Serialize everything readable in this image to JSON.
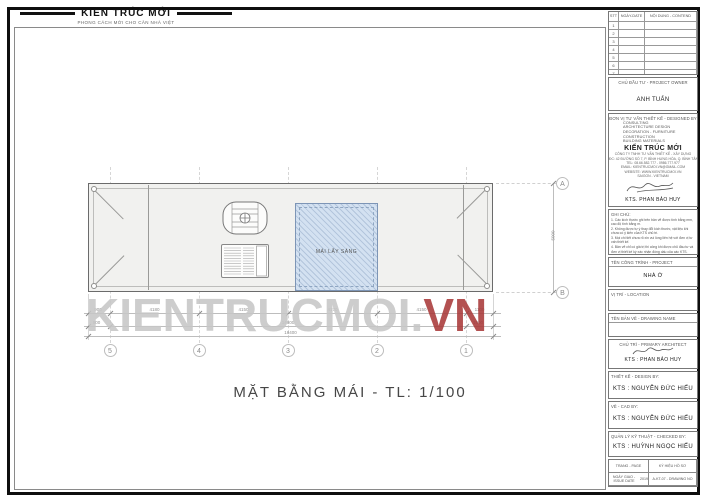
{
  "logo": {
    "title": "KIẾN TRÚC MỚI",
    "subtitle": "PHONG CÁCH MỚI CHO CĂN NHÀ VIỆT"
  },
  "watermark": {
    "gray": "KIENTRUCMOI.",
    "red": "VN"
  },
  "drawing": {
    "title": "MẶT BẰNG MÁI - TL: 1/100",
    "skylight_label": "MÁI LẤY SÁNG",
    "grid_cols": [
      "5",
      "4",
      "3",
      "2",
      "1"
    ],
    "grid_rows": [
      "A",
      "B"
    ],
    "dims": {
      "row1": [
        "900",
        "4180",
        "4150",
        "4170",
        "4150",
        "1100"
      ],
      "row2": [
        "900",
        "14600",
        "1800"
      ],
      "total": "16400",
      "vertical": "5000"
    }
  },
  "titleblock": {
    "revision": {
      "col_no": "STT",
      "col_date": "NGÀY-DATE",
      "col_content": "NỘI DUNG - CONTEND",
      "rows": [
        "1",
        "2",
        "3",
        "4",
        "5",
        "6",
        "7"
      ]
    },
    "owner": {
      "label": "CHỦ ĐẦU TƯ - PROJECT OWNER",
      "name": "ANH TUẤN"
    },
    "designer": {
      "label": "ĐƠN VỊ TƯ VẤN THIẾT KẾ - DESIGNED BY",
      "services": [
        "CONSULTING",
        "ARCHITECTURE DESIGN",
        "DECORATION - FURNITURE",
        "CONSTRUCTION",
        "BUILDING MATERIALS"
      ],
      "brand": "KIẾN TRÚC MỚI",
      "company": "CÔNG TY TNHH TƯ VẤN THIẾT KẾ - XÂY DỰNG",
      "address_lines": [
        "ĐC: 42 ĐƯỜNG SỐ 7, P. BÌNH HƯNG HÒA, Q. BÌNH TÂN, TP.HCM",
        "TEL: 08.66.582.777 - 0986.777.977",
        "EMAIL: KIENTRUCMOI.VN@GMAIL.COM",
        "WEBSITE: WWW.KIENTRUCMOI.VN",
        "SAIGON - VIETNAM"
      ],
      "architect": "KTS. PHAN BẢO HUY"
    },
    "notes": {
      "label": "GHI CHÚ:",
      "items": [
        "1. Các kích thước ghi trên bản vẽ được tính bằng mm, cao độ tính bằng m.",
        "2. Không được tự ý thay đổi kích thước, vật liệu khi chưa có ý kiến của KTS chủ trì.",
        "3. Mọi chi tiết chưa rõ xin vui lòng liên hệ với đơn vị tư vấn thiết kế.",
        "4. Bản vẽ chỉ có giá trị thi công khi được chủ đầu tư và đơn vị thiết kế ký xác nhận đóng dấu của các KTS."
      ]
    },
    "project": {
      "label": "TÊN CÔNG TRÌNH - PROJECT",
      "name": "NHÀ Ở"
    },
    "location": {
      "label": "VỊ TRÍ - LOCATION",
      "value": ""
    },
    "drawing_name": {
      "label": "TÊN BẢN VẼ - DRAWING NAME",
      "value": ""
    },
    "primary": {
      "label": "CHỦ TRÌ - PRIMARY ARCHITECT",
      "name": "KTS : PHAN BẢO HUY"
    },
    "design_by": {
      "label": "THIẾT KẾ - DESIGN BY:",
      "name": "KTS : NGUYỄN ĐỨC HIẾU"
    },
    "cad_by": {
      "label": "VẼ - CAD BY:",
      "name": "KTS : NGUYỄN ĐỨC HIẾU"
    },
    "checked_by": {
      "label": "QUẢN LÝ KỸ THUẬT - CHECKED BY:",
      "name": "KTS : HUỲNH NGỌC HIẾU"
    },
    "footer": {
      "page_label": "TRANG - PAGE",
      "file_label": "KÝ HIỆU HỒ SƠ",
      "issue_label": "NGÀY GIAO - ISSUE DATE",
      "issue_value": "2019",
      "drawing_no": "A-KT-07 - DRAWING NO"
    }
  },
  "colors": {
    "accent_red": "#a93a3a",
    "skylight": "#d3e1f1",
    "roof_fill": "#f1f1ef"
  }
}
